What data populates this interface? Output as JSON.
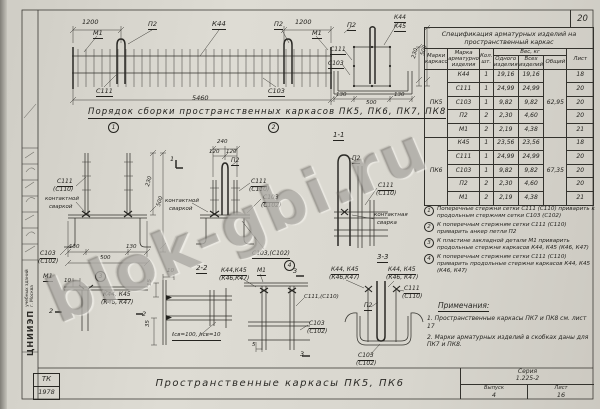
{
  "page": {
    "number": "20",
    "watermark": "blok-gbi.ru"
  },
  "sidebar": {
    "org_name": "ЦНИИЭП",
    "org_line2": "учебных зданий",
    "org_line3": "г. Москва",
    "stamp_tk": "ТК",
    "stamp_year": "1978"
  },
  "title_block": {
    "main_title": "Пространственные каркасы ПК5, ПК6",
    "series_label": "Серия",
    "series_value": "1.225-2",
    "issue_label": "Выпуск",
    "issue_value": "4",
    "sheet_label": "Лист",
    "sheet_value": "16"
  },
  "spec_table": {
    "title": "Спецификация арматурных изделий на пространственный каркас",
    "headers": {
      "frame_marks": "Марки каркасов",
      "item": "Марка арматурного изделия",
      "qty": "Кол. шт.",
      "weight": "Вес, кг",
      "one": "Одного изделия",
      "all": "Всех изделий",
      "total": "Общий",
      "sheet": "Лист"
    },
    "groups": [
      {
        "mark": "ПК5",
        "total": "62,95",
        "rows": [
          {
            "item": "К44",
            "qty": "1",
            "one": "19,16",
            "all": "19,16",
            "sheet": "18"
          },
          {
            "item": "С111",
            "qty": "1",
            "one": "24,99",
            "all": "24,99",
            "sheet": "20"
          },
          {
            "item": "С103",
            "qty": "1",
            "one": "9,82",
            "all": "9,82",
            "sheet": "20"
          },
          {
            "item": "П2",
            "qty": "2",
            "one": "2,30",
            "all": "4,60",
            "sheet": "20"
          },
          {
            "item": "М1",
            "qty": "2",
            "one": "2,19",
            "all": "4,38",
            "sheet": "21"
          }
        ]
      },
      {
        "mark": "ПК6",
        "total": "67,35",
        "rows": [
          {
            "item": "К45",
            "qty": "1",
            "one": "23,56",
            "all": "23,56",
            "sheet": "18"
          },
          {
            "item": "С111",
            "qty": "1",
            "one": "24,99",
            "all": "24,99",
            "sheet": "20"
          },
          {
            "item": "С103",
            "qty": "1",
            "one": "9,82",
            "all": "9,82",
            "sheet": "20"
          },
          {
            "item": "П2",
            "qty": "2",
            "one": "2,30",
            "all": "4,60",
            "sheet": "20"
          },
          {
            "item": "М1",
            "qty": "2",
            "one": "2,19",
            "all": "4,38",
            "sheet": "21"
          }
        ]
      }
    ]
  },
  "callouts": [
    {
      "num": "1",
      "text": "Поперечные стержни сетки С111 (С110) приварить к продольным стержням сетки С103 (С102)"
    },
    {
      "num": "2",
      "text": "К поперечным стержням сетки С111 (С110) приварить анкер петли П2"
    },
    {
      "num": "3",
      "text": "К пластине закладной детали М1 приварить продольные стержни каркасов К44, К45 (К46, К47)"
    },
    {
      "num": "4",
      "text": "К поперечным стержням сетки С111 (С110) приварить продольные стержни каркасов К44, К45 (К46, К47)"
    }
  ],
  "notes": {
    "title": "Примечания:",
    "items": [
      "1. Пространственные каркасы ПК7 и ПК8 см. лист 17",
      "2. Марки арматурных изделий в скобках даны для ПК7 и ПК8."
    ]
  },
  "drawing_labels": [
    {
      "t": "1200",
      "x": 82,
      "y": 19,
      "s": 6.5
    },
    {
      "t": "М1",
      "x": 93,
      "y": 30,
      "s": 6.5,
      "u": 1
    },
    {
      "t": "П2",
      "x": 148,
      "y": 21,
      "s": 6.5,
      "u": 1
    },
    {
      "t": "К44",
      "x": 212,
      "y": 21,
      "s": 7,
      "u": 1
    },
    {
      "t": "П2",
      "x": 274,
      "y": 21,
      "s": 6.5,
      "u": 1
    },
    {
      "t": "1200",
      "x": 295,
      "y": 19,
      "s": 6.5
    },
    {
      "t": "М1",
      "x": 312,
      "y": 30,
      "s": 6.5,
      "u": 1
    },
    {
      "t": "С111",
      "x": 96,
      "y": 88,
      "s": 6.5,
      "u": 1
    },
    {
      "t": "С103",
      "x": 268,
      "y": 88,
      "s": 6.5,
      "u": 1
    },
    {
      "t": "5460",
      "x": 192,
      "y": 95,
      "s": 6.5
    },
    {
      "t": "П2",
      "x": 347,
      "y": 22,
      "s": 6.5,
      "u": 1
    },
    {
      "t": "К44",
      "x": 394,
      "y": 15,
      "s": 6,
      "u": 1
    },
    {
      "t": "К45",
      "x": 394,
      "y": 24,
      "s": 6,
      "u": 1
    },
    {
      "t": "С111",
      "x": 330,
      "y": 47,
      "s": 6,
      "u": 1
    },
    {
      "t": "С103",
      "x": 328,
      "y": 61,
      "s": 6,
      "u": 1
    },
    {
      "t": "130",
      "x": 336,
      "y": 93,
      "s": 5.5
    },
    {
      "t": "500",
      "x": 366,
      "y": 101,
      "s": 5.5
    },
    {
      "t": "130",
      "x": 394,
      "y": 93,
      "s": 5.5
    },
    {
      "t": "230",
      "x": 412,
      "y": 58,
      "s": 5.5,
      "r": -75
    },
    {
      "t": "500",
      "x": 421,
      "y": 55,
      "s": 5.5,
      "r": -75
    },
    {
      "n": "assembly-order-heading",
      "t": "Порядок сборки пространственных каркасов ПК5, ПК6, ПК7, ПК8",
      "x": 88,
      "y": 108,
      "s": 8.5,
      "u": 1,
      "ls": 1.1
    },
    {
      "t": "1",
      "x": 108,
      "y": 122,
      "c": 1,
      "n": "step-1-number"
    },
    {
      "t": "2",
      "x": 268,
      "y": 122,
      "c": 1,
      "n": "step-2-number"
    },
    {
      "n": "section-1-1-label",
      "t": "1-1",
      "x": 333,
      "y": 132,
      "s": 7,
      "u": 1
    },
    {
      "t": "С111",
      "x": 57,
      "y": 179,
      "s": 6,
      "u": 1
    },
    {
      "t": "(С110)",
      "x": 53,
      "y": 187,
      "s": 6
    },
    {
      "t": "контактной",
      "x": 45,
      "y": 197,
      "s": 5.5
    },
    {
      "t": "сваркой",
      "x": 49,
      "y": 205,
      "s": 5.5
    },
    {
      "t": "С103",
      "x": 40,
      "y": 251,
      "s": 6,
      "u": 1
    },
    {
      "t": "(С102)",
      "x": 38,
      "y": 259,
      "s": 6
    },
    {
      "t": "130",
      "x": 69,
      "y": 245,
      "s": 5.5
    },
    {
      "t": "130",
      "x": 126,
      "y": 245,
      "s": 5.5
    },
    {
      "t": "500",
      "x": 100,
      "y": 256,
      "s": 5.5
    },
    {
      "t": "230",
      "x": 146,
      "y": 186,
      "s": 5.5,
      "r": -75
    },
    {
      "t": "500",
      "x": 157,
      "y": 206,
      "s": 5.5,
      "r": -75
    },
    {
      "t": "1",
      "x": 170,
      "y": 156,
      "s": 6.5
    },
    {
      "t": "240",
      "x": 217,
      "y": 140,
      "s": 5.5
    },
    {
      "t": "120",
      "x": 209,
      "y": 150,
      "s": 5.5
    },
    {
      "t": "120",
      "x": 226,
      "y": 150,
      "s": 5.5
    },
    {
      "t": "П2",
      "x": 231,
      "y": 158,
      "s": 6,
      "u": 1
    },
    {
      "t": "С111",
      "x": 251,
      "y": 179,
      "s": 6,
      "u": 1
    },
    {
      "t": "(С110)",
      "x": 249,
      "y": 187,
      "s": 6
    },
    {
      "t": "С103",
      "x": 263,
      "y": 195,
      "s": 6,
      "u": 1
    },
    {
      "t": "(С102)",
      "x": 261,
      "y": 203,
      "s": 6
    },
    {
      "t": "контактной",
      "x": 165,
      "y": 199,
      "s": 5.5
    },
    {
      "t": "сваркой",
      "x": 169,
      "y": 207,
      "s": 5.5
    },
    {
      "t": "С103,(С102)",
      "x": 252,
      "y": 251,
      "s": 6,
      "u": 1
    },
    {
      "t": "4",
      "x": 284,
      "y": 260,
      "c": 1,
      "n": "step-4-number"
    },
    {
      "t": "П2",
      "x": 352,
      "y": 156,
      "s": 6,
      "u": 1
    },
    {
      "t": "С111",
      "x": 378,
      "y": 183,
      "s": 6,
      "u": 1
    },
    {
      "t": "(С110)",
      "x": 376,
      "y": 191,
      "s": 6
    },
    {
      "t": "контактная",
      "x": 374,
      "y": 213,
      "s": 5.5
    },
    {
      "t": "сварка",
      "x": 377,
      "y": 221,
      "s": 5.5
    },
    {
      "t": "М1",
      "x": 43,
      "y": 273,
      "s": 6.5,
      "u": 1
    },
    {
      "t": "3",
      "x": 95,
      "y": 271,
      "c": 1,
      "n": "step-3-number"
    },
    {
      "t": "10",
      "x": 64,
      "y": 279,
      "s": 5.5
    },
    {
      "t": "К44, К45",
      "x": 103,
      "y": 292,
      "s": 6,
      "u": 1
    },
    {
      "t": "(К46, К47)",
      "x": 101,
      "y": 300,
      "s": 6
    },
    {
      "t": "2",
      "x": 49,
      "y": 308,
      "s": 6.5
    },
    {
      "t": "2",
      "x": 142,
      "y": 311,
      "s": 6.5
    },
    {
      "n": "section-2-2-label",
      "t": "2-2",
      "x": 196,
      "y": 265,
      "s": 7,
      "u": 1
    },
    {
      "t": "10",
      "x": 167,
      "y": 269,
      "s": 5.5
    },
    {
      "t": "15",
      "x": 148,
      "y": 286,
      "s": 5.5,
      "r": -90
    },
    {
      "t": "35",
      "x": 146,
      "y": 327,
      "s": 5.5,
      "r": -90
    },
    {
      "t": "ℓсв=100, hсв=10",
      "x": 172,
      "y": 333,
      "s": 5.5,
      "u": 1
    },
    {
      "t": "К44,К45",
      "x": 221,
      "y": 268,
      "s": 6,
      "u": 1
    },
    {
      "t": "(К46,К47)",
      "x": 219,
      "y": 276,
      "s": 6
    },
    {
      "t": "М1",
      "x": 257,
      "y": 268,
      "s": 6,
      "u": 1
    },
    {
      "t": "3",
      "x": 293,
      "y": 268,
      "s": 6.5
    },
    {
      "t": "3",
      "x": 300,
      "y": 351,
      "s": 6.5
    },
    {
      "t": "5",
      "x": 252,
      "y": 343,
      "s": 5.5
    },
    {
      "t": "С111,(С110)",
      "x": 304,
      "y": 295,
      "s": 5.5
    },
    {
      "t": "С103",
      "x": 309,
      "y": 321,
      "s": 6,
      "u": 1
    },
    {
      "t": "(С102)",
      "x": 307,
      "y": 329,
      "s": 6
    },
    {
      "n": "section-3-3-label",
      "t": "3-3",
      "x": 377,
      "y": 254,
      "s": 7,
      "u": 1
    },
    {
      "t": "К44, К45",
      "x": 331,
      "y": 267,
      "s": 6,
      "u": 1
    },
    {
      "t": "(К46,К47)",
      "x": 329,
      "y": 275,
      "s": 6
    },
    {
      "t": "К44, К45",
      "x": 388,
      "y": 267,
      "s": 6,
      "u": 1
    },
    {
      "t": "(К46, К47)",
      "x": 386,
      "y": 275,
      "s": 6
    },
    {
      "t": "С111",
      "x": 404,
      "y": 286,
      "s": 6,
      "u": 1
    },
    {
      "t": "(С110)",
      "x": 402,
      "y": 294,
      "s": 6
    },
    {
      "t": "П2",
      "x": 364,
      "y": 303,
      "s": 6,
      "u": 1
    },
    {
      "t": "С103",
      "x": 358,
      "y": 353,
      "s": 6,
      "u": 1
    },
    {
      "t": "(С102)",
      "x": 356,
      "y": 361,
      "s": 6
    }
  ]
}
